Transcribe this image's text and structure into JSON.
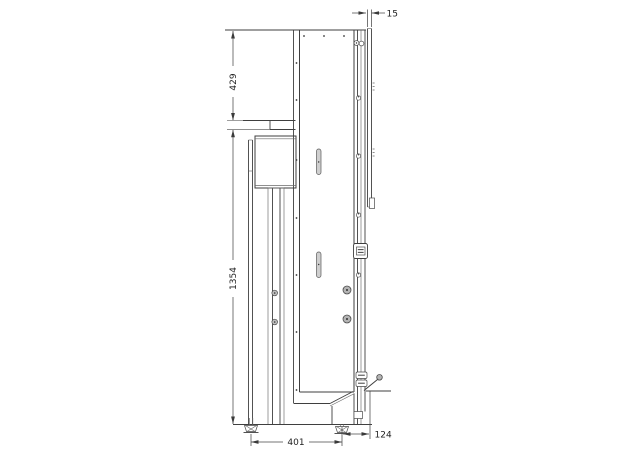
{
  "drawing": {
    "title": "machine-side-elevation",
    "dimensions": {
      "plate_thickness": "15",
      "top_section_height": "429",
      "main_column_height": "1354",
      "foot_spacing": "401",
      "right_offset": "124"
    },
    "colors": {
      "line": "#3f3f3f",
      "thin_line": "#6a6a6a",
      "text": "#1f1f1f",
      "bolt_gray": "#b4b4b4",
      "slot_gray": "#cfcfcf",
      "background": "#ffffff"
    }
  }
}
